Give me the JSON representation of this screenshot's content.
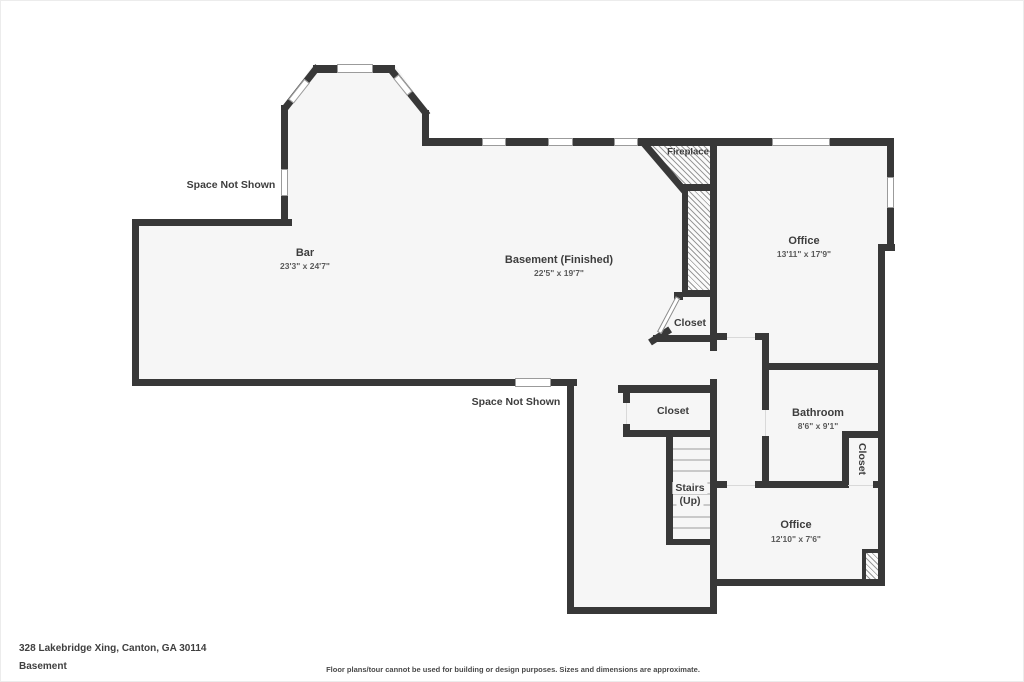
{
  "plan": {
    "title_area": {
      "space_not_shown_upper": "Space Not Shown",
      "space_not_shown_lower": "Space Not Shown"
    },
    "rooms": {
      "bar": {
        "name": "Bar",
        "dims": "23'3\" x 24'7\""
      },
      "basement": {
        "name": "Basement (Finished)",
        "dims": "22'5\" x 19'7\""
      },
      "office_upper": {
        "name": "Office",
        "dims": "13'11\" x 17'9\""
      },
      "bathroom": {
        "name": "Bathroom",
        "dims": "8'6\" x 9'1\""
      },
      "office_lower": {
        "name": "Office",
        "dims": "12'10\" x 7'6\""
      },
      "fireplace": {
        "name": "Fireplace"
      },
      "closet_upper": {
        "name": "Closet"
      },
      "closet_hall": {
        "name": "Closet"
      },
      "closet_bath": {
        "name": "Closet"
      },
      "stairs": {
        "name": "Stairs",
        "direction": "(Up)"
      }
    },
    "colors": {
      "wall": "#383838",
      "floor": "#f6f6f6",
      "hatch_line": "#9a9a9a",
      "label_text": "#3d3d3d"
    }
  },
  "footer": {
    "address": "328 Lakebridge Xing, Canton, GA 30114",
    "floor_label": "Basement",
    "disclaimer": "Floor plans/tour cannot be used for building or design purposes. Sizes and dimensions are approximate."
  }
}
